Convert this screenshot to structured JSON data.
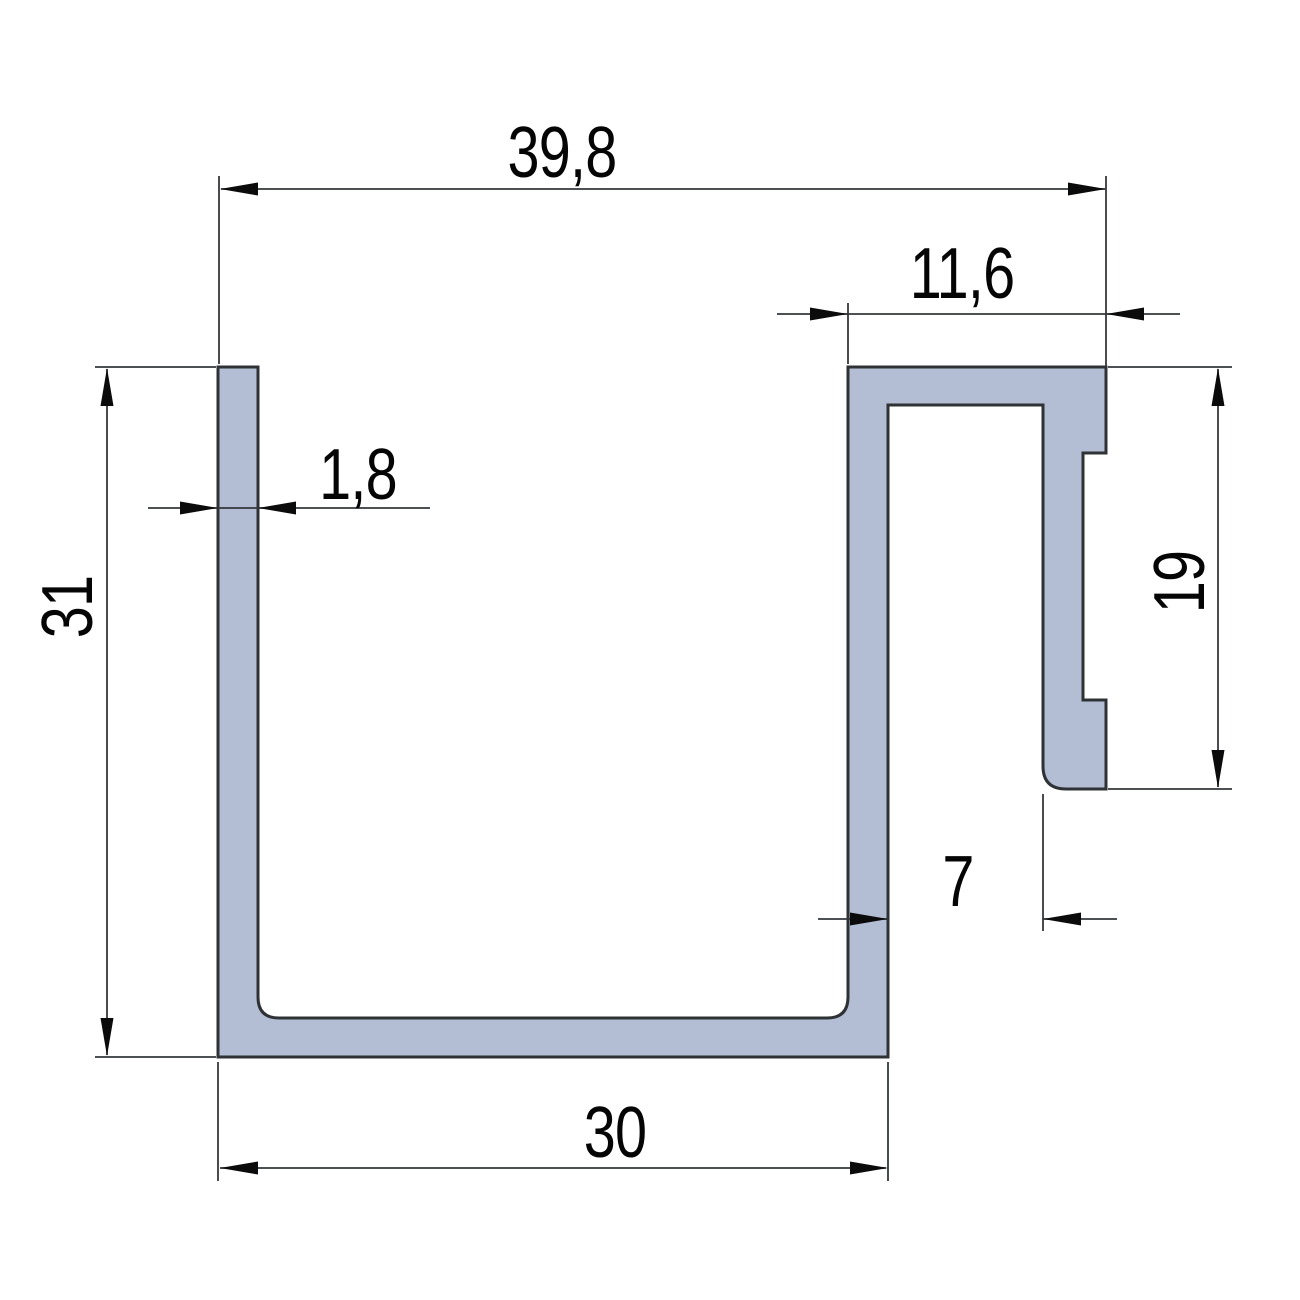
{
  "drawing": {
    "kind": "technical-cross-section-drawing",
    "subject": "hook-channel profile cross-section",
    "units_implied": "mm",
    "decimal_separator": ",",
    "background_color": "#ffffff",
    "profile": {
      "fill_color": "#b3bdd3",
      "outline_color": "#2f3235",
      "description": "Open C-channel with top-right hook flange, notched leg and rounded foot"
    },
    "dimension_line_color": "#35383b",
    "text_color": "#050505",
    "dimensions": [
      {
        "id": "overall-width",
        "value": "39,8",
        "orientation": "horizontal",
        "measures": "overall width across the top"
      },
      {
        "id": "hook-flange-width",
        "value": "11,6",
        "orientation": "horizontal",
        "measures": "width of top hook flange"
      },
      {
        "id": "wall-thickness",
        "value": "1,8",
        "orientation": "horizontal",
        "measures": "left wall thickness"
      },
      {
        "id": "overall-height",
        "value": "31",
        "orientation": "vertical",
        "measures": "overall channel height"
      },
      {
        "id": "hook-height",
        "value": "19",
        "orientation": "vertical",
        "measures": "hook leg height"
      },
      {
        "id": "slot-width",
        "value": "7",
        "orientation": "horizontal",
        "measures": "gap between channel wall and hook leg"
      },
      {
        "id": "channel-width",
        "value": "30",
        "orientation": "horizontal",
        "measures": "outer width of channel at bottom"
      }
    ]
  }
}
